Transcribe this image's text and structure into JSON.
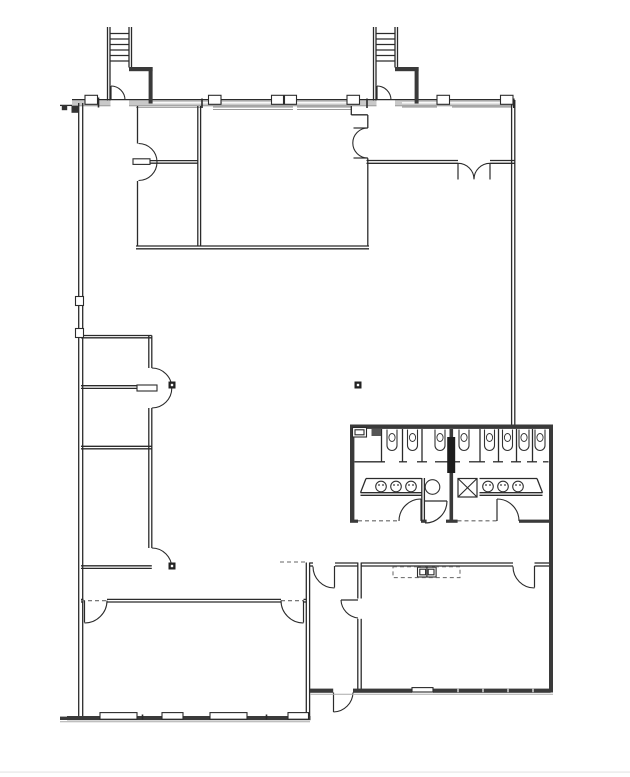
{
  "canvas": {
    "width": 630,
    "height": 777,
    "background": "#ffffff"
  },
  "palette": {
    "wall": "#2b2b2b",
    "hairline": "#8a8a8a",
    "band_fill": "#c9c9c9",
    "band_glass": "#ffffff",
    "thick_fill": "#3a3a3a",
    "chase_fill": "#1d1d1d",
    "dash": "#666666",
    "sill": "#aaaaaa",
    "marker": "#222222",
    "fixture": "#333333",
    "page_edge": "#e9e9e9"
  },
  "floorplan": {
    "band": {
      "x": 72,
      "y": 100.2,
      "w": 442,
      "h": 5.2
    },
    "walls_thin": [
      [
        107.5,
        27,
        107.5,
        100.5
      ],
      [
        110,
        27,
        110,
        100.5
      ],
      [
        129,
        27,
        129,
        67.5
      ],
      [
        131.5,
        27,
        131.5,
        67.5
      ],
      [
        373.5,
        27,
        373.5,
        100.5
      ],
      [
        376,
        27,
        376,
        100.5
      ],
      [
        395,
        27,
        395,
        67.5
      ],
      [
        397.5,
        27,
        397.5,
        67.5
      ],
      [
        110,
        33.5,
        129,
        33.5
      ],
      [
        110,
        39,
        129,
        39
      ],
      [
        110,
        44.5,
        129,
        44.5
      ],
      [
        110,
        50,
        129,
        50
      ],
      [
        110,
        55.5,
        129,
        55.5
      ],
      [
        110,
        61,
        129,
        61
      ],
      [
        376,
        33.5,
        395,
        33.5
      ],
      [
        376,
        39,
        395,
        39
      ],
      [
        376,
        44.5,
        395,
        44.5
      ],
      [
        376,
        50,
        395,
        50
      ],
      [
        376,
        55.5,
        395,
        55.5
      ],
      [
        376,
        61,
        395,
        61
      ],
      [
        72,
        99.6,
        514,
        99.6
      ],
      [
        60,
        105.4,
        72,
        105.4
      ],
      [
        78.7,
        103,
        78.7,
        719
      ],
      [
        82.7,
        103,
        82.7,
        719
      ],
      [
        511.6,
        100,
        511.6,
        425
      ],
      [
        514.8,
        100,
        514.8,
        425
      ],
      [
        137.5,
        106,
        137.5,
        143.5
      ],
      [
        137.5,
        181,
        137.5,
        246
      ],
      [
        150,
        160.6,
        197.8,
        160.6
      ],
      [
        150,
        163.2,
        197.8,
        163.2
      ],
      [
        197.8,
        106,
        197.8,
        246
      ],
      [
        200.6,
        106,
        200.6,
        246
      ],
      [
        136,
        246,
        369,
        246
      ],
      [
        136,
        248.8,
        369,
        248.8
      ],
      [
        367.8,
        115,
        367.8,
        128
      ],
      [
        367.8,
        158.3,
        367.8,
        246
      ],
      [
        351.3,
        106,
        351.3,
        115
      ],
      [
        351.3,
        114.8,
        367.8,
        114.8
      ],
      [
        366.5,
        160.5,
        458,
        160.5
      ],
      [
        366.5,
        163.3,
        458,
        163.3
      ],
      [
        490,
        160.5,
        514.8,
        160.5
      ],
      [
        490,
        163.3,
        514.8,
        163.3
      ],
      [
        81,
        335.5,
        151.8,
        335.5
      ],
      [
        81,
        337.8,
        151.8,
        337.8
      ],
      [
        148.8,
        335.5,
        148.8,
        368
      ],
      [
        151.8,
        335.5,
        151.8,
        368
      ],
      [
        148.8,
        408,
        148.8,
        548
      ],
      [
        151.8,
        408,
        151.8,
        548
      ],
      [
        81,
        385.7,
        137,
        385.7
      ],
      [
        81,
        388.4,
        137,
        388.4
      ],
      [
        81,
        446.3,
        151.8,
        446.3
      ],
      [
        81,
        448.8,
        151.8,
        448.8
      ],
      [
        81,
        565.8,
        151.8,
        565.8
      ],
      [
        81,
        568.4,
        151.8,
        568.4
      ],
      [
        81,
        599.4,
        83.5,
        599.4
      ],
      [
        81,
        602,
        83.5,
        602
      ],
      [
        107,
        599.4,
        281,
        599.4
      ],
      [
        107,
        602,
        281,
        602
      ],
      [
        303.5,
        599.4,
        306.3,
        599.4
      ],
      [
        303.5,
        602,
        306.3,
        602
      ],
      [
        306.3,
        562.5,
        306.3,
        692
      ],
      [
        309.6,
        562.5,
        309.6,
        692
      ],
      [
        357.8,
        562.5,
        357.8,
        598.5
      ],
      [
        361.2,
        562.5,
        361.2,
        598.5
      ],
      [
        357.8,
        618.8,
        357.8,
        692
      ],
      [
        361.2,
        618.8,
        361.2,
        692
      ],
      [
        306.3,
        692,
        306.3,
        716
      ],
      [
        309.6,
        692,
        309.6,
        716
      ],
      [
        309.6,
        563,
        313,
        563
      ],
      [
        309.6,
        566,
        313,
        566
      ],
      [
        335,
        563,
        357.8,
        563
      ],
      [
        335,
        566,
        357.8,
        566
      ],
      [
        361.2,
        563,
        513,
        563
      ],
      [
        361.2,
        566,
        513,
        566
      ],
      [
        534.5,
        563,
        549,
        563
      ],
      [
        534.5,
        566,
        549,
        566
      ],
      [
        421.8,
        478,
        421.8,
        521
      ],
      [
        424.4,
        478,
        424.4,
        521
      ],
      [
        381.5,
        429,
        381.5,
        462
      ],
      [
        402.5,
        429,
        402.5,
        462
      ],
      [
        422,
        429,
        422,
        462
      ],
      [
        480,
        429,
        480,
        462
      ],
      [
        498.5,
        429,
        498.5,
        462
      ],
      [
        516.5,
        429,
        516.5,
        462
      ],
      [
        532.5,
        429,
        532.5,
        462
      ],
      [
        354.5,
        461.8,
        385,
        461.8
      ],
      [
        399,
        461.8,
        407,
        461.8
      ],
      [
        417,
        461.8,
        427,
        461.8
      ],
      [
        435,
        461.8,
        448,
        461.8
      ],
      [
        454.5,
        461.8,
        460,
        461.8
      ],
      [
        469,
        461.8,
        485,
        461.8
      ],
      [
        493,
        461.8,
        503,
        461.8
      ],
      [
        511,
        461.8,
        521,
        461.8
      ],
      [
        527,
        461.8,
        537,
        461.8
      ],
      [
        543,
        461.8,
        548.5,
        461.8
      ],
      [
        366,
        478.5,
        421.5,
        478.5
      ],
      [
        360.5,
        492.7,
        421.5,
        492.7
      ],
      [
        366,
        478.5,
        360.5,
        492.7
      ],
      [
        360.5,
        495.3,
        421.5,
        495.3
      ],
      [
        479.5,
        478.5,
        537,
        478.5
      ],
      [
        479.5,
        492.7,
        542.5,
        492.7
      ],
      [
        537,
        478.5,
        542.5,
        492.7
      ],
      [
        479.5,
        495.3,
        542.5,
        495.3
      ],
      [
        172.5,
        712.6,
        172.5,
        719.2
      ],
      [
        298,
        712.6,
        298,
        719.2
      ]
    ],
    "hairlines": [
      [
        72,
        105.8,
        514,
        105.8
      ],
      [
        136,
        107.3,
        200,
        107.3
      ],
      [
        213,
        107,
        293,
        107
      ],
      [
        213,
        109.4,
        293,
        109.4
      ],
      [
        297,
        107,
        352,
        107
      ],
      [
        297,
        109.4,
        352,
        109.4
      ],
      [
        402,
        107,
        437,
        107
      ],
      [
        452,
        107,
        511,
        107
      ]
    ],
    "band_glass_lines": [
      [
        152,
        102.8,
        208,
        102.8
      ],
      [
        222,
        102.8,
        271,
        102.8
      ],
      [
        297,
        102.8,
        347,
        102.8
      ],
      [
        402,
        102.8,
        437,
        102.8
      ],
      [
        450,
        102.8,
        500,
        102.8
      ]
    ],
    "sills": [
      [
        60,
        721.8,
        310,
        721.8
      ],
      [
        310,
        694.2,
        553,
        694.2
      ]
    ],
    "ticks_dark": [
      [
        98.5,
        97.5,
        98.5,
        107.5
      ],
      [
        202,
        98.5,
        202,
        108
      ],
      [
        367,
        98.5,
        367,
        108
      ],
      [
        513.8,
        98.5,
        513.8,
        108
      ],
      [
        142.5,
        714.5,
        142.5,
        719.5
      ],
      [
        266.5,
        714.5,
        266.5,
        719.5
      ]
    ],
    "ticks_white": [
      [
        458,
        688.8,
        458,
        692.2
      ],
      [
        483,
        688.8,
        483,
        692.2
      ],
      [
        508,
        688.8,
        508,
        692.2
      ],
      [
        533,
        688.8,
        533,
        692.2
      ]
    ],
    "gap_rects": [
      [
        110.5,
        98.6,
        18.5,
        8.2
      ],
      [
        376.5,
        98.6,
        18.5,
        8.2
      ],
      [
        549.4,
        484,
        3.4,
        10
      ],
      [
        549.4,
        612,
        3.4,
        26
      ]
    ],
    "thick_rects": [
      {
        "x": 129,
        "y": 67,
        "w": 23.6,
        "h": 4.2,
        "name": "stair1-vestibule-wall"
      },
      {
        "x": 148.6,
        "y": 67,
        "w": 4,
        "h": 36.5,
        "name": "stair1-vestibule-wall"
      },
      {
        "x": 395,
        "y": 67,
        "w": 23.6,
        "h": 4.2,
        "name": "stair2-vestibule-wall"
      },
      {
        "x": 414.6,
        "y": 67,
        "w": 4,
        "h": 36.5,
        "name": "stair2-vestibule-wall"
      },
      {
        "x": 350,
        "y": 424.5,
        "w": 203,
        "h": 4.4,
        "name": "restroom-north-wall"
      },
      {
        "x": 350,
        "y": 424.5,
        "w": 4.4,
        "h": 98,
        "name": "restroom-west-wall"
      },
      {
        "x": 549,
        "y": 424.5,
        "w": 4,
        "h": 268,
        "name": "east-exterior-wall"
      },
      {
        "x": 449.5,
        "y": 429,
        "w": 3.6,
        "h": 92.5,
        "name": "restroom-center-wall"
      },
      {
        "x": 447.2,
        "y": 437,
        "w": 8,
        "h": 36,
        "fill": "#1d1d1d",
        "name": "plumbing-chase"
      },
      {
        "x": 67,
        "y": 716,
        "w": 243.5,
        "h": 4.2,
        "name": "south-exterior-wall"
      },
      {
        "x": 60,
        "y": 716.6,
        "w": 7.2,
        "h": 3.4,
        "name": "south-exterior-wall"
      },
      {
        "x": 310,
        "y": 688.6,
        "w": 23.2,
        "h": 4.2,
        "name": "south-exterior-wall"
      },
      {
        "x": 353,
        "y": 688.6,
        "w": 59,
        "h": 4.2,
        "name": "south-exterior-wall"
      },
      {
        "x": 433,
        "y": 688.6,
        "w": 117.6,
        "h": 4.2,
        "name": "south-exterior-wall"
      },
      {
        "x": 350,
        "y": 519.6,
        "w": 8,
        "h": 3.2,
        "name": "restroom-south-wall"
      },
      {
        "x": 421,
        "y": 519.6,
        "w": 5.6,
        "h": 3.2,
        "name": "restroom-south-wall"
      },
      {
        "x": 446,
        "y": 519.6,
        "w": 11.6,
        "h": 3.2,
        "name": "restroom-south-wall"
      },
      {
        "x": 519,
        "y": 519.6,
        "w": 34,
        "h": 3.2,
        "name": "restroom-south-wall"
      },
      {
        "x": 71.5,
        "y": 105.8,
        "w": 7.2,
        "h": 7,
        "fill": "#333333",
        "name": "west-corner-pier"
      },
      {
        "x": 61.8,
        "y": 105,
        "w": 5.4,
        "h": 5.2,
        "fill": "#333333",
        "name": "west-corner-pier"
      }
    ],
    "outline_rects": [
      {
        "x": 133,
        "y": 158.8,
        "w": 17,
        "h": 5.6,
        "name": "wall-end-stub"
      },
      {
        "x": 137,
        "y": 385,
        "w": 20,
        "h": 6,
        "name": "wall-end-stub"
      },
      {
        "x": 85,
        "y": 95.3,
        "w": 12.5,
        "h": 9,
        "name": "column-block"
      },
      {
        "x": 208.5,
        "y": 95.3,
        "w": 12.5,
        "h": 9,
        "name": "column-block"
      },
      {
        "x": 271.5,
        "y": 95.3,
        "w": 12,
        "h": 9,
        "name": "column-block"
      },
      {
        "x": 284.5,
        "y": 95.3,
        "w": 12,
        "h": 9,
        "name": "column-block"
      },
      {
        "x": 347,
        "y": 95.3,
        "w": 12.5,
        "h": 9,
        "name": "column-block"
      },
      {
        "x": 437,
        "y": 95.3,
        "w": 12.5,
        "h": 9,
        "name": "column-block"
      },
      {
        "x": 500.5,
        "y": 95.3,
        "w": 12.5,
        "h": 9,
        "name": "column-block"
      },
      {
        "x": 75.5,
        "y": 296.5,
        "w": 8,
        "h": 9,
        "name": "wall-pilaster"
      },
      {
        "x": 75.5,
        "y": 328.5,
        "w": 8,
        "h": 9,
        "name": "wall-pilaster"
      },
      {
        "x": 100,
        "y": 712.6,
        "w": 37,
        "h": 6.6,
        "name": "window"
      },
      {
        "x": 162,
        "y": 712.6,
        "w": 21,
        "h": 6.6,
        "name": "window"
      },
      {
        "x": 210,
        "y": 712.6,
        "w": 37,
        "h": 6.6,
        "name": "window"
      },
      {
        "x": 288,
        "y": 712.6,
        "w": 20.5,
        "h": 6.6,
        "name": "window"
      },
      {
        "x": 412,
        "y": 687.6,
        "w": 21,
        "h": 4.4,
        "name": "window"
      },
      {
        "x": 352.5,
        "y": 427.5,
        "w": 14,
        "h": 9.5,
        "name": "urinal-icon"
      },
      {
        "x": 355,
        "y": 429.8,
        "w": 9,
        "h": 5,
        "name": "urinal-icon"
      },
      {
        "x": 417.5,
        "y": 567.2,
        "w": 18.6,
        "h": 9.8,
        "name": "kitchen-sink-icon"
      },
      {
        "x": 419.8,
        "y": 569.2,
        "w": 5.8,
        "h": 5.6,
        "name": "kitchen-sink-icon"
      },
      {
        "x": 428.2,
        "y": 569.2,
        "w": 5.8,
        "h": 5.6,
        "name": "kitchen-sink-icon"
      }
    ],
    "filled_rects": [
      {
        "x": 371.5,
        "y": 428.5,
        "w": 9.5,
        "h": 7.5,
        "fill": "#555555",
        "name": "dispenser-icon"
      }
    ],
    "xbox": {
      "x": 458,
      "y": 478.5,
      "w": 19,
      "h": 18.5
    },
    "dashed_lines": [
      [
        358,
        520.8,
        399,
        520.8
      ],
      [
        457.5,
        520.8,
        497,
        520.8
      ],
      [
        280,
        562,
        306.3,
        562
      ],
      [
        81,
        600.7,
        107,
        600.7
      ],
      [
        281,
        600.7,
        303.5,
        600.7
      ]
    ],
    "dashed_rects": [
      {
        "x": 393,
        "y": 566.8,
        "w": 67,
        "h": 10.8,
        "name": "upper-cabinet-dashed"
      }
    ],
    "door_arcs": [
      "M 111,86 A 14,14 0 0 1 125,100",
      "M 377,86 A 14,14 0 0 1 391,100",
      "M 138.5,143.5 A 18.5,18.5 0 0 1 157,162",
      "M 138.5,180.5 A 18.5,18.5 0 0 0 157,162",
      "M 367.8,128 A 15,15 0 0 0 352.8,143",
      "M 367.8,158 A 15,15 0 0 1 352.8,143",
      "M 458,163.3 A 16,16 0 0 1 474,179.3",
      "M 490,163.3 A 16,16 0 0 0 474,179.3",
      "M 151.8,368 A 20,20 0 0 1 171.8,388",
      "M 151.8,408 A 20,20 0 0 0 171.8,388",
      "M 151.8,548 A 20,20 0 0 1 171.8,568",
      "M 313,566.5 A 21.5,21.5 0 0 0 334.5,588",
      "M 341,600 A 19,19 0 0 0 358,618",
      "M 353,692.5 A 20,20 0 0 1 333.5,712",
      "M 513,566.5 A 21.5,21.5 0 0 0 534.5,588",
      "M 107,600.5 A 22.5,22.5 0 0 1 84.5,623",
      "M 281,600.5 A 22.5,22.5 0 0 0 303.5,623",
      "M 399,521 A 22,22 0 0 1 421,499",
      "M 497,499 A 22,22 0 0 1 519,521",
      "M 447,501 A 22,22 0 0 1 425,523"
    ],
    "door_leaves": [
      [
        111,
        86,
        111,
        100
      ],
      [
        377,
        86,
        377,
        100
      ],
      [
        353.5,
        128,
        367.8,
        128
      ],
      [
        353.5,
        158,
        367.8,
        158
      ],
      [
        458,
        163.3,
        458,
        179.5
      ],
      [
        490,
        163.3,
        490,
        179.5
      ],
      [
        334.5,
        566,
        334.5,
        587.5
      ],
      [
        341,
        600,
        358,
        600
      ],
      [
        333.5,
        692.5,
        333.5,
        712
      ],
      [
        534.5,
        566,
        534.5,
        587.5
      ],
      [
        84.5,
        600.5,
        84.5,
        622.5
      ],
      [
        303.5,
        600.5,
        303.5,
        622.5
      ],
      [
        421,
        499,
        421,
        521
      ],
      [
        497,
        499,
        497,
        521
      ],
      [
        425,
        501,
        447,
        501
      ],
      [
        426.9,
        567.2,
        426.9,
        577
      ]
    ],
    "toilets": {
      "cx": [
        392,
        412.5,
        440,
        464,
        489.5,
        507.5,
        524,
        540
      ],
      "top": 429.5,
      "depth": 16,
      "half_w": 5
    },
    "sinks": {
      "cx": [
        381,
        396,
        411,
        488,
        503,
        518
      ],
      "cy": 486.5,
      "r": 5.3
    },
    "circles": [
      {
        "cx": 432.5,
        "cy": 487,
        "r": 7.3,
        "name": "mop-sink-icon"
      }
    ],
    "markers": [
      {
        "x": 168.5,
        "y": 381.5
      },
      {
        "x": 168.5,
        "y": 562.5
      },
      {
        "x": 354.5,
        "y": 381.5
      }
    ],
    "page_edge_rect": {
      "x": 0,
      "y": 771.4,
      "w": 630,
      "h": 1.4
    }
  }
}
